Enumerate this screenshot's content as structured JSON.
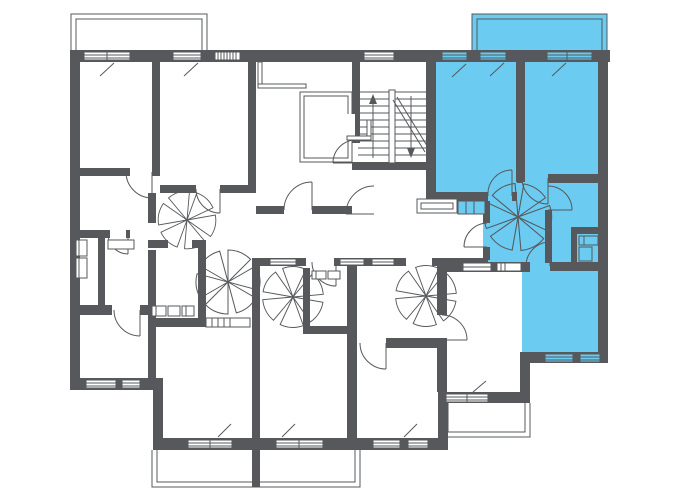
{
  "page": {
    "title": "Building floor plan"
  },
  "colors": {
    "background": "#ffffff",
    "wall": "#56585b",
    "line": "#56585b",
    "highlight": "#6bcbf0"
  },
  "plan": {
    "highlighted_apartment": {
      "highlighted": true,
      "fill": "#6bcbf0",
      "features": [
        "room",
        "room",
        "hall",
        "bathroom",
        "wc",
        "bedroom",
        "balcony"
      ]
    },
    "common_features": [
      "staircase",
      "elevator-shaft",
      "entrance-lobby",
      "corridor"
    ],
    "balconies": [
      "top-left",
      "top-right-highlighted",
      "bottom-middle",
      "bottom-right"
    ]
  }
}
